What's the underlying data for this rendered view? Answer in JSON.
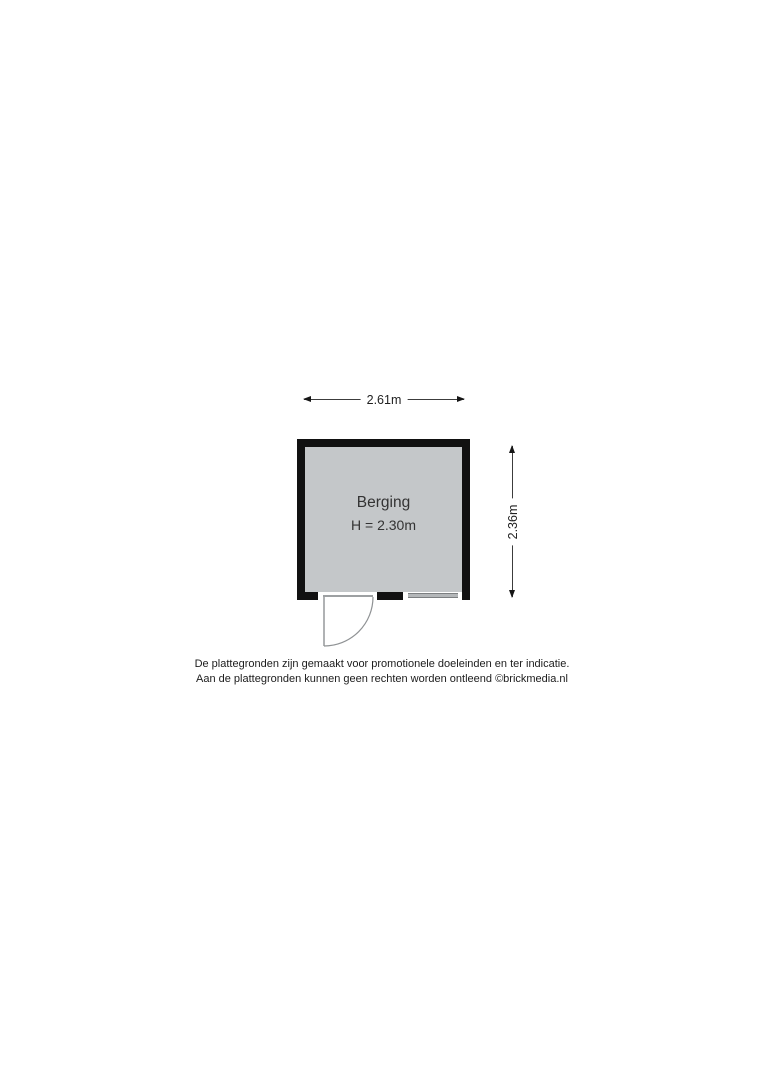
{
  "floorplan": {
    "room": {
      "label": "Berging",
      "height_label": "H = 2.30m"
    },
    "dimensions": {
      "width_label": "2.61m",
      "height_label": "2.36m"
    },
    "features": {
      "door": "hinged-door-bottom-left-swing-out",
      "window": "window-bottom-right"
    },
    "colors": {
      "wall": "#111111",
      "room_fill": "#c4c7c9",
      "door_line": "#8f9294",
      "window_fill": "#b4b7b9",
      "window_edge": "#7c7f81",
      "dimension_line": "#3c3c3c",
      "arrowhead": "#161616",
      "text": "#333333"
    }
  },
  "disclaimer": {
    "line1": "De plattegronden zijn gemaakt voor promotionele doeleinden en ter indicatie.",
    "line2": "Aan de plattegronden kunnen geen rechten worden ontleend ©brickmedia.nl"
  }
}
